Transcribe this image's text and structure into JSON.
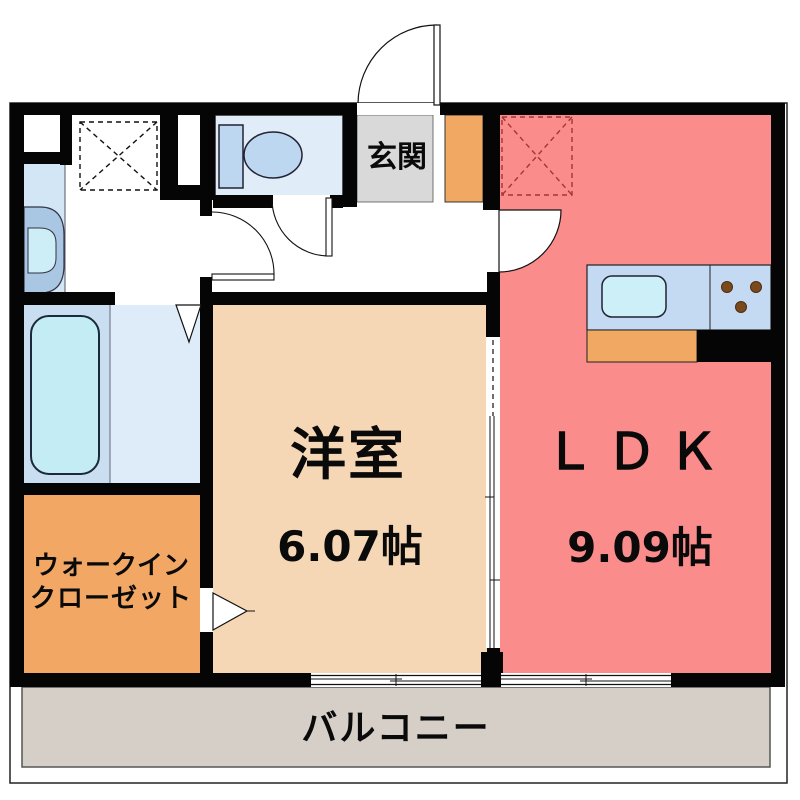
{
  "floorplan": {
    "rooms": {
      "entrance": {
        "label": "玄関"
      },
      "western_room": {
        "label": "洋室",
        "area": "6.07帖"
      },
      "ldk": {
        "label": "ＬＤＫ",
        "area": "9.09帖"
      },
      "walk_in_closet": {
        "label_line_1": "ウォークイン",
        "label_line_2": "クローゼット"
      },
      "balcony": {
        "label": "バルコニー"
      }
    },
    "colors": {
      "wall": "#050505",
      "ldk_red": "#fb8c8c",
      "western_tan": "#f5d7b5",
      "closet_orange": "#f2a864",
      "entrance_gray": "#d9d9d9",
      "shoe_cabinet_orange": "#f0a863",
      "balcony_gray": "#d6cfc8",
      "toilet_room_blue": "#e0edf9",
      "fixture_blue": "#bdd7f0",
      "bath_left_blue": "#cadef1",
      "bath_right_blue": "#ddecf8",
      "tub_cyan": "#c3ecf4",
      "vanity_blue": "#d3e6f5",
      "basin_rim_blue": "#a9c6e2",
      "basin_bowl_cyan": "#cdeef7",
      "counter_blue": "#c4daf3",
      "sink_cyan": "#cdeff7",
      "burner_brown": "#7b4a1c",
      "ldk_hatch_red": "#a63535"
    }
  }
}
